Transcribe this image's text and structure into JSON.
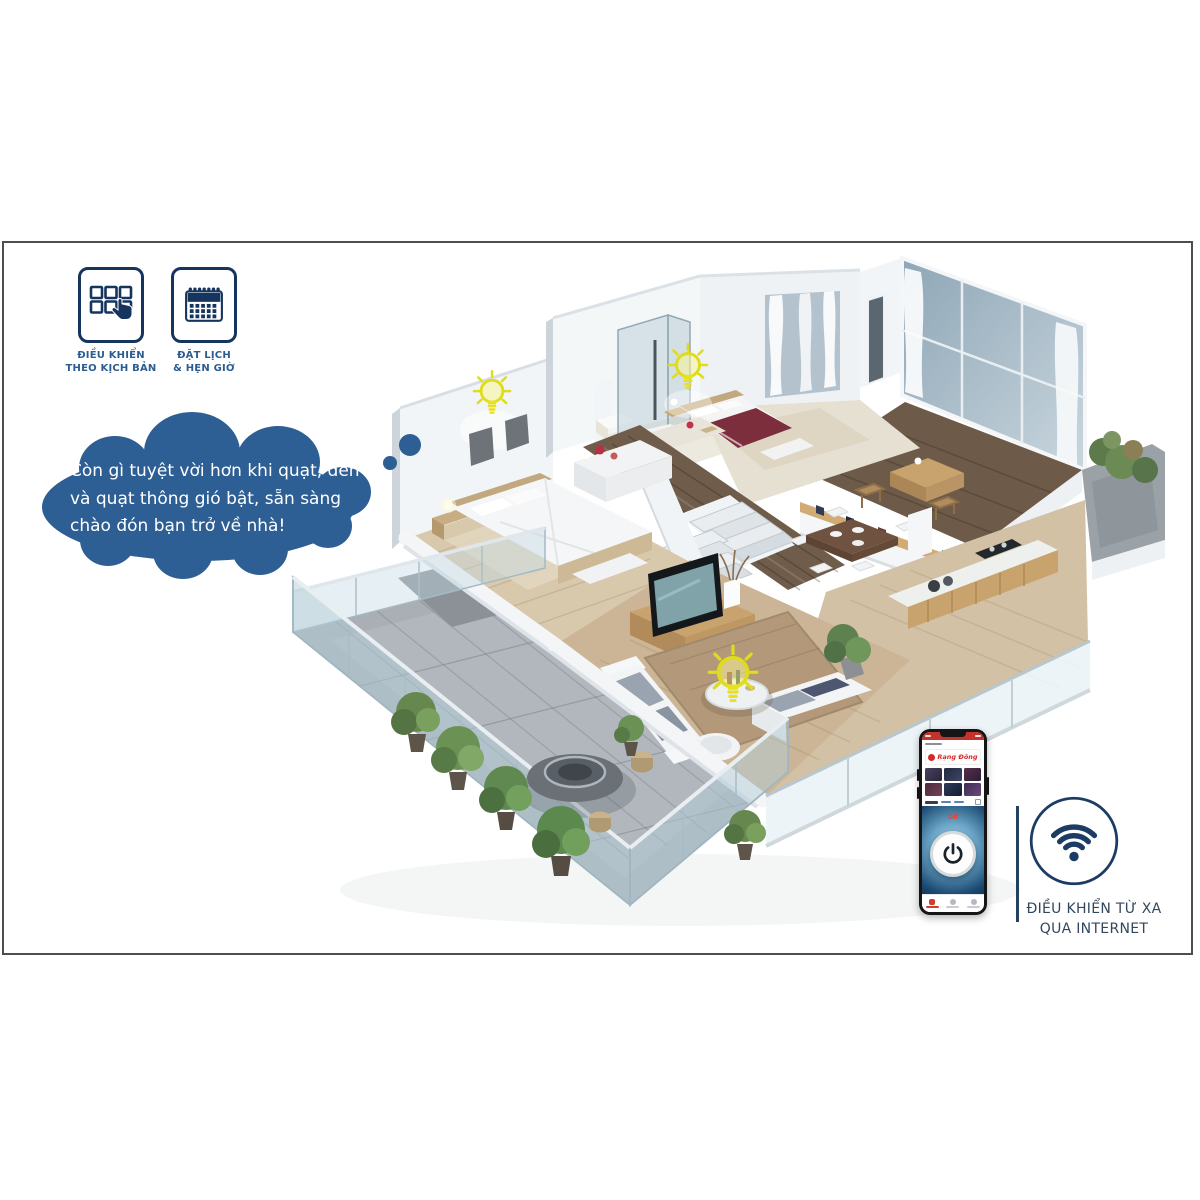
{
  "page": {
    "background": "#ffffff",
    "frame_border": "#4e4e4e"
  },
  "features": [
    {
      "name": "scenario-control",
      "icon": "grid-hand-icon",
      "label_line1": "ĐIỀU KHIỂN",
      "label_line2": "THEO KỊCH BẢN"
    },
    {
      "name": "schedule-timer",
      "icon": "calendar-icon",
      "label_line1": "ĐẶT LỊCH",
      "label_line2": "& HẸN GIỜ"
    }
  ],
  "thought_bubble": {
    "color": "#2e5f94",
    "lines": [
      "Còn gì tuyệt vời hơn khi quạt, đèn",
      "và quạt thông gió bật, sẵn sàng",
      "chào đón bạn trở về nhà!"
    ]
  },
  "house": {
    "type": "3d-cutaway-smart-home-render",
    "smart_lights": 3,
    "rooms": [
      "bedroom-left",
      "bathroom",
      "bedroom-middle",
      "loft-study",
      "dining-area",
      "kitchen",
      "living-room",
      "terrace",
      "balcony"
    ]
  },
  "phone": {
    "brand": "Rạng Đông",
    "power_label": "Off",
    "accent_red": "#d42a28",
    "panel_blue": "#1c4a72"
  },
  "remote_control": {
    "icon": "wifi-icon",
    "label_line1": "ĐIỀU KHIỂN TỪ XA",
    "label_line2": "QUA INTERNET",
    "color": "#1d3c64"
  },
  "colors": {
    "accent_navy": "#16355e",
    "label_blue": "#2d5c92",
    "bulb_yellow": "#e6e222"
  }
}
